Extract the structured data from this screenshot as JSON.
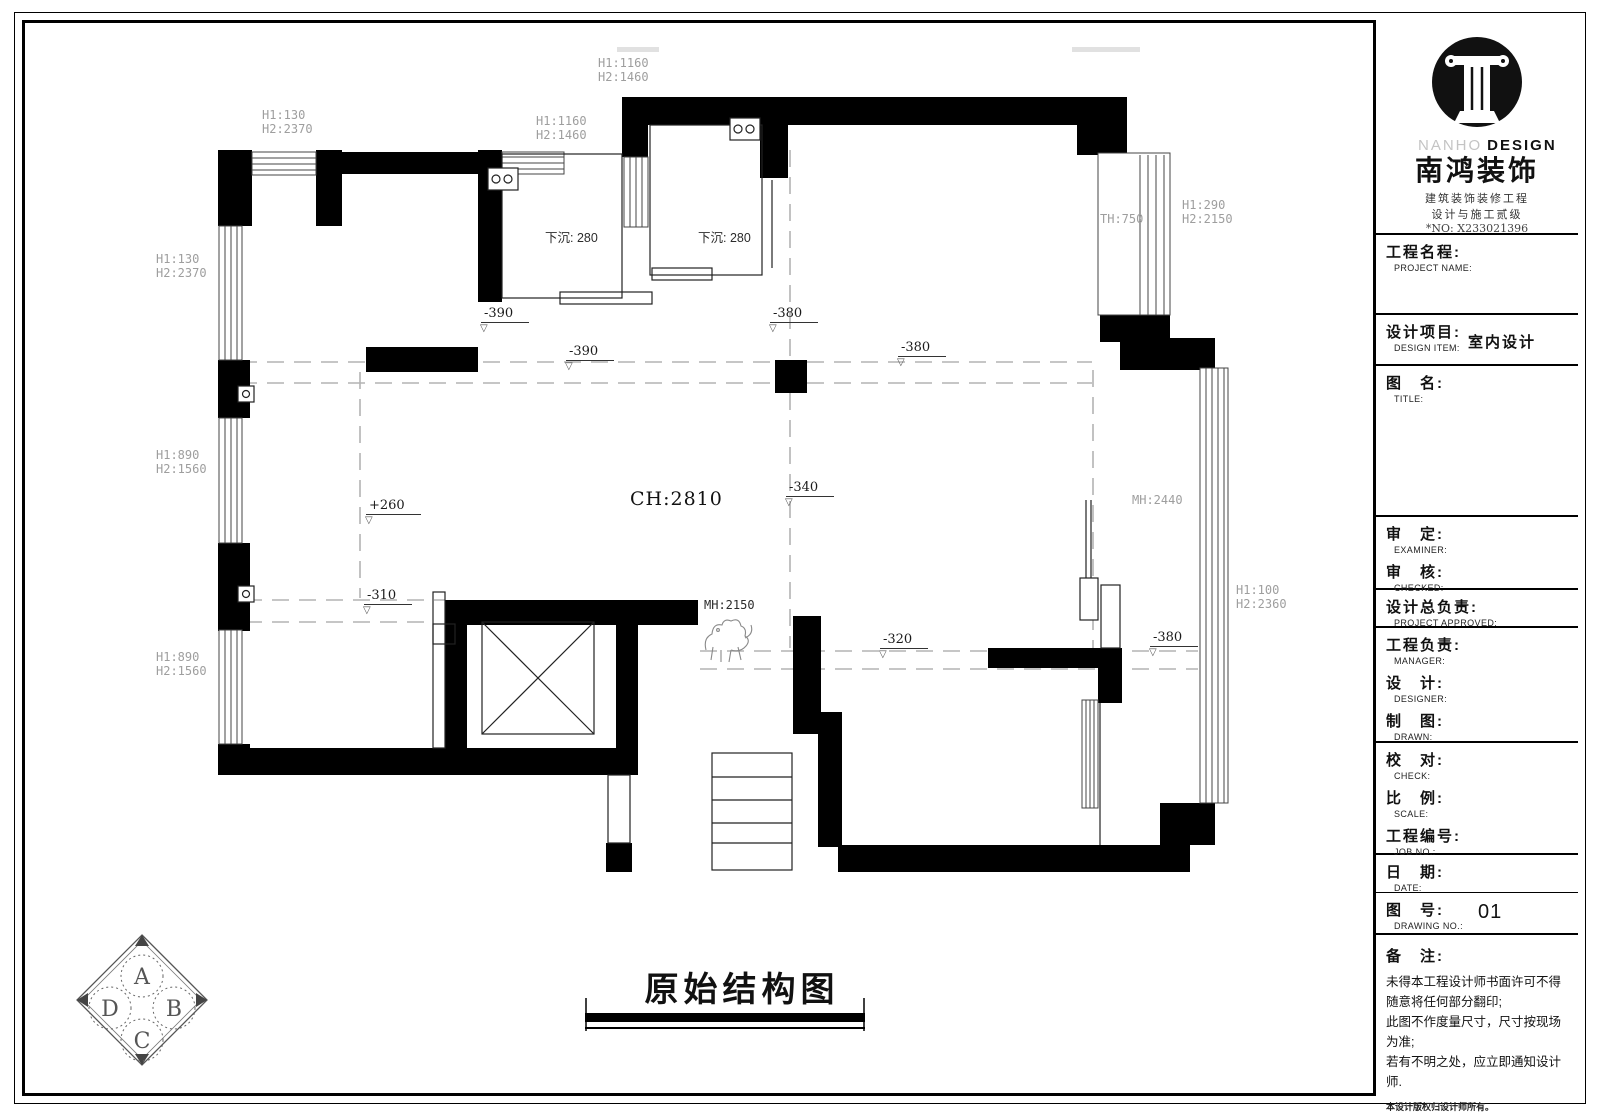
{
  "logo": {
    "en_light": "NANHO",
    "en_bold": "DESIGN",
    "cn": "南鸿装饰",
    "line1": "建筑装饰装修工程",
    "line2": "设计与施工贰级",
    "cert": "*NO: X233021396"
  },
  "titleblock": {
    "rows": [
      {
        "cn": "工程名程:",
        "en": "PROJECT NAME:",
        "value": ""
      },
      {
        "cn": "设计项目:",
        "en": "DESIGN ITEM:",
        "value": "室内设计"
      },
      {
        "cn": "图　名:",
        "en": "TITLE:",
        "value": ""
      },
      {
        "cn": "审　定:",
        "en": "EXAMINER:",
        "value": ""
      },
      {
        "cn": "审　核:",
        "en": "CHECKED:",
        "value": ""
      },
      {
        "cn": "设计总负责:",
        "en": "PROJECT APPROVED:",
        "value": ""
      },
      {
        "cn": "工程负责:",
        "en": "MANAGER:",
        "value": ""
      },
      {
        "cn": "设　计:",
        "en": "DESIGNER:",
        "value": ""
      },
      {
        "cn": "制　图:",
        "en": "DRAWN:",
        "value": ""
      },
      {
        "cn": "校　对:",
        "en": "CHECK:",
        "value": ""
      },
      {
        "cn": "比　例:",
        "en": "SCALE:",
        "value": ""
      },
      {
        "cn": "工程编号:",
        "en": "JOB NO.:",
        "value": ""
      },
      {
        "cn": "日　期:",
        "en": "DATE:",
        "value": ""
      },
      {
        "cn": "图　号:",
        "en": "DRAWING NO.:",
        "value": "01"
      }
    ],
    "remarks": {
      "title": "备　注:",
      "lines": [
        "未得本工程设计师书面许可不得",
        "随意将任何部分翻印;",
        "此图不作度量尺寸，尺寸按现场",
        "为准;",
        "若有不明之处，应立即通知设计",
        "师."
      ],
      "fine": "本设计版权归设计师所有。",
      "phone": "免费咨询电话:400 8385 168"
    }
  },
  "plan": {
    "title": "原始结构图",
    "labels": [
      {
        "l1": "H1:1160",
        "l2": "H2:1460"
      },
      {
        "l1": "H1:1160",
        "l2": "H2:1460"
      },
      {
        "l1": "H1:130",
        "l2": "H2:2370"
      },
      {
        "l1": "H1:130",
        "l2": "H2:2370"
      },
      {
        "l1": "下沉: 280"
      },
      {
        "l1": "下沉: 280"
      },
      {
        "l1": "H1:290",
        "l2": "H2:2150"
      },
      {
        "l1": "TH:750"
      },
      {
        "l1": "-390"
      },
      {
        "l1": "-390"
      },
      {
        "l1": "-380"
      },
      {
        "l1": "-380"
      },
      {
        "l1": "H1:890",
        "l2": "H2:1560"
      },
      {
        "l1": "H1:890",
        "l2": "H2:1560"
      },
      {
        "l1": "+260"
      },
      {
        "l1": "CH:2810"
      },
      {
        "l1": "-340"
      },
      {
        "l1": "MH:2440"
      },
      {
        "l1": "-310"
      },
      {
        "l1": "MH:2150"
      },
      {
        "l1": "-320"
      },
      {
        "l1": "-380"
      },
      {
        "l1": "H1:100",
        "l2": "H2:2360"
      }
    ]
  },
  "compass": {
    "letters": [
      "A",
      "B",
      "C",
      "D"
    ]
  }
}
